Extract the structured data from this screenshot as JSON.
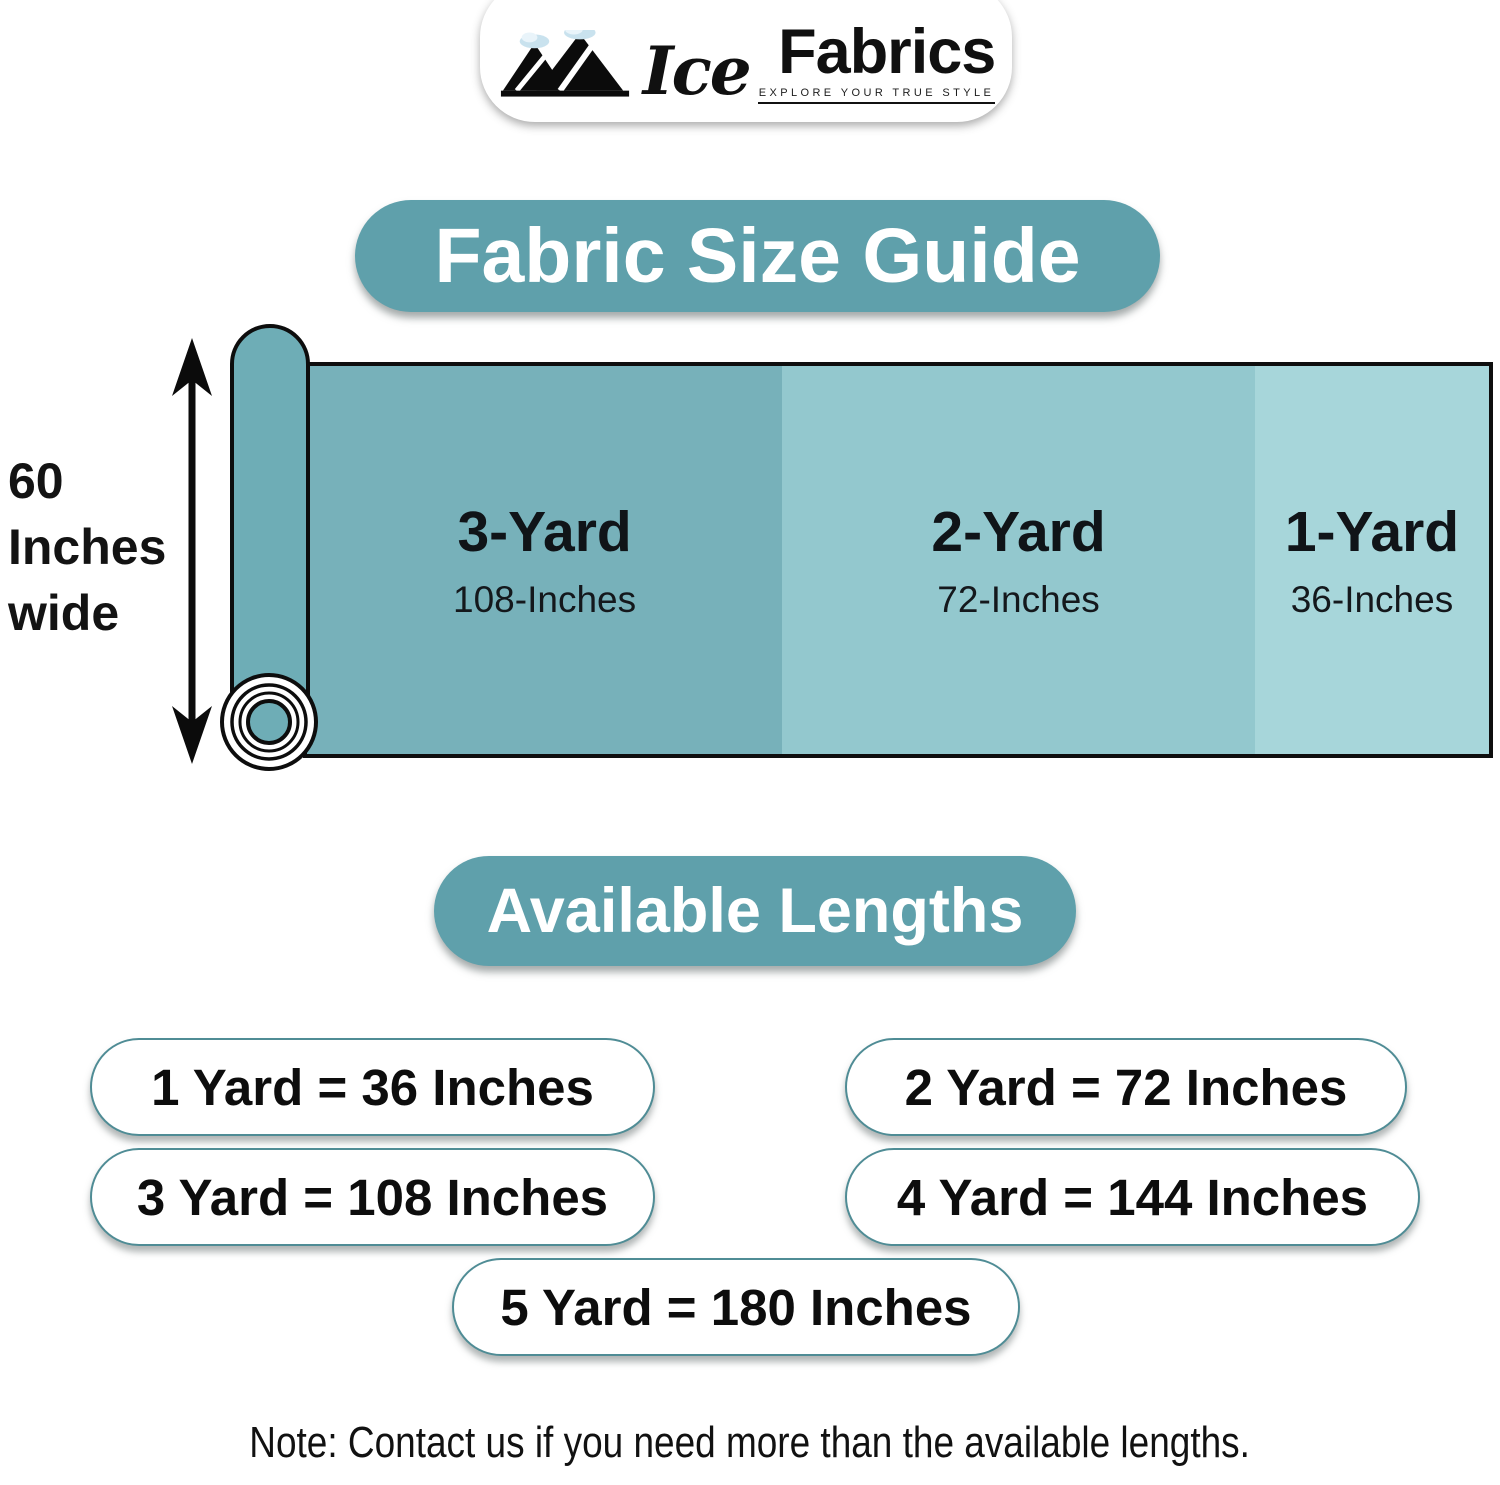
{
  "logo": {
    "brand_script": "Ice",
    "brand_main": "Fabrics",
    "tagline": "EXPLORE YOUR TRUE STYLE"
  },
  "title": "Fabric Size Guide",
  "diagram": {
    "width_label": {
      "line1": "60",
      "line2": "Inches",
      "line3": "wide"
    },
    "sections": [
      {
        "label": "3-Yard",
        "inches": "108-Inches"
      },
      {
        "label": "2-Yard",
        "inches": "72-Inches"
      },
      {
        "label": "1-Yard",
        "inches": "36-Inches"
      }
    ]
  },
  "available_lengths": {
    "title": "Available Lengths",
    "pills": [
      "1 Yard = 36 Inches",
      "2 Yard = 72 Inches",
      "3 Yard = 108 Inches",
      "4 Yard = 144 Inches",
      "5 Yard = 180 Inches"
    ]
  },
  "note": "Note: Contact us if you need more than the available lengths.",
  "colors": {
    "accent": "#5fa0ab",
    "roll_tube": "#6eadb6",
    "section_3yard": "#77b1ba",
    "section_2yard": "#93c8ce",
    "section_1yard": "#a7d6da",
    "pill_border": "#4f8c95",
    "snow": "#c9e2ee",
    "ink": "#101010"
  }
}
